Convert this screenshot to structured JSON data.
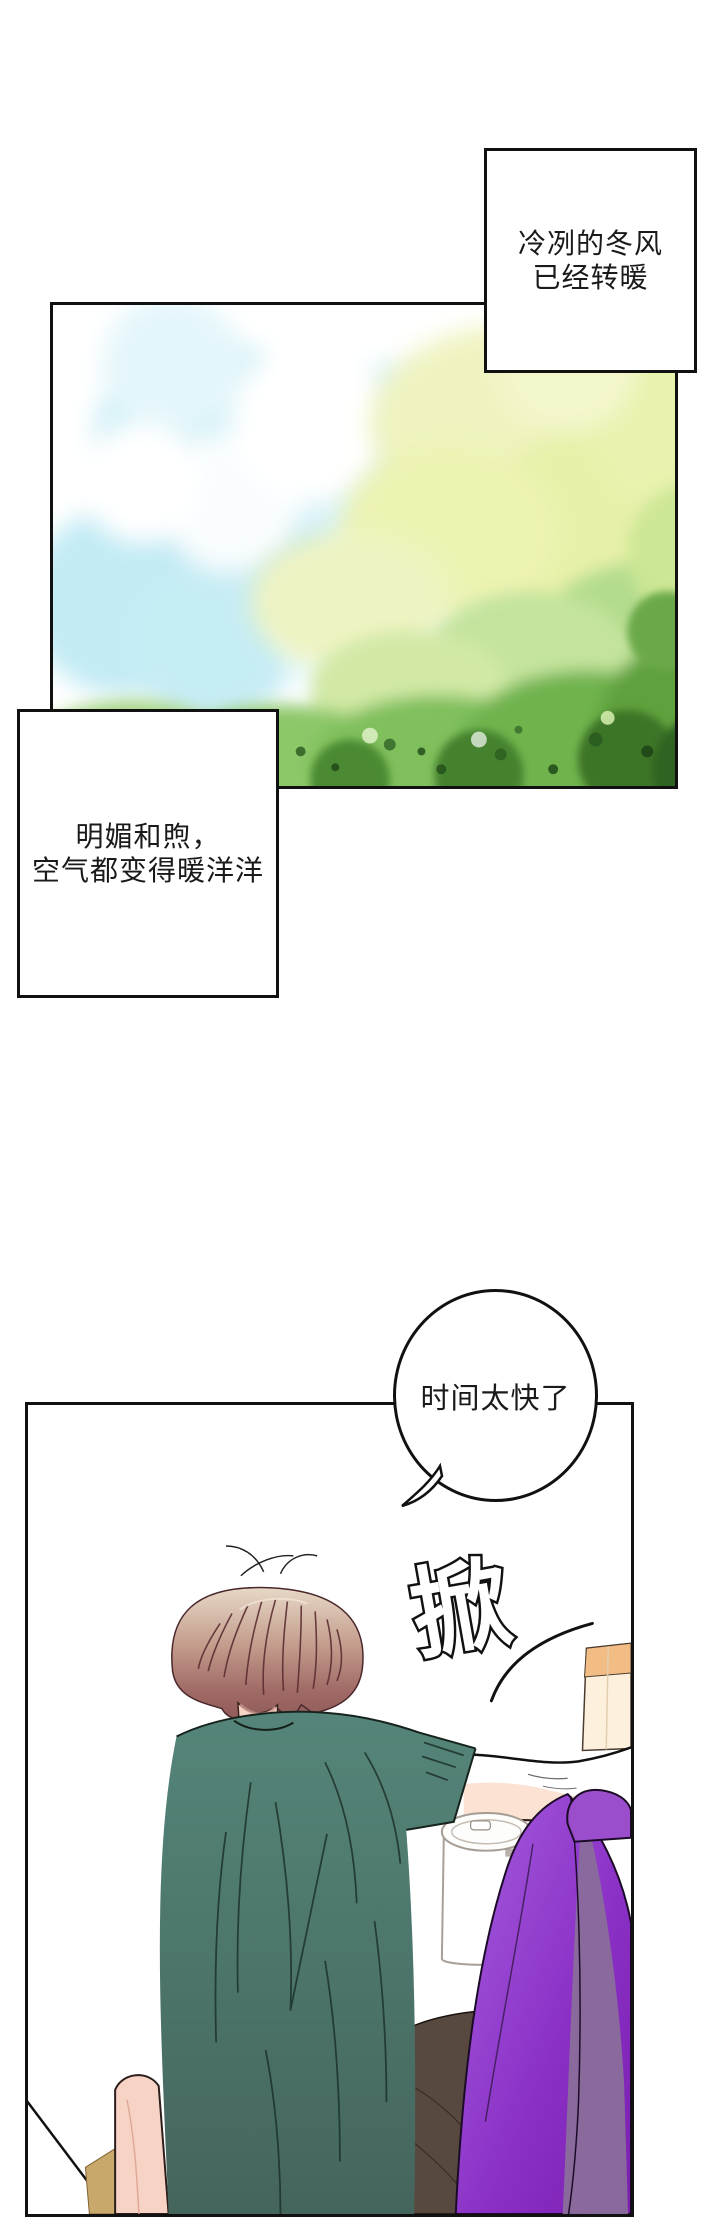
{
  "comic": {
    "caption_top": {
      "line1": "冷冽的冬风",
      "line2": "已经转暖"
    },
    "caption_left": {
      "line1": "明媚和煦，",
      "line2": "空气都变得暖洋洋"
    },
    "speech_bubble": {
      "text": "时间太快了"
    },
    "sfx": {
      "text": "掀"
    },
    "colors": {
      "ink": "#111111",
      "sky_cyan": "#bfe9f2",
      "foliage_pale": "#edf3b2",
      "foliage_green": "#7fbf5c",
      "foliage_dark": "#2f6323",
      "hair_top": "#e7d8c6",
      "hair_bottom": "#8f5a58",
      "shirt_teal": "#4e7c71",
      "skin": "#f6d3c5",
      "blanket_purple": "#8a2fc5",
      "blanket_muted": "#8a6d9b",
      "bedding_white": "#ffffff",
      "furniture_tan": "#f2bc85",
      "wood_tan": "#c9a96b",
      "shadow_brown": "#57493f"
    }
  }
}
